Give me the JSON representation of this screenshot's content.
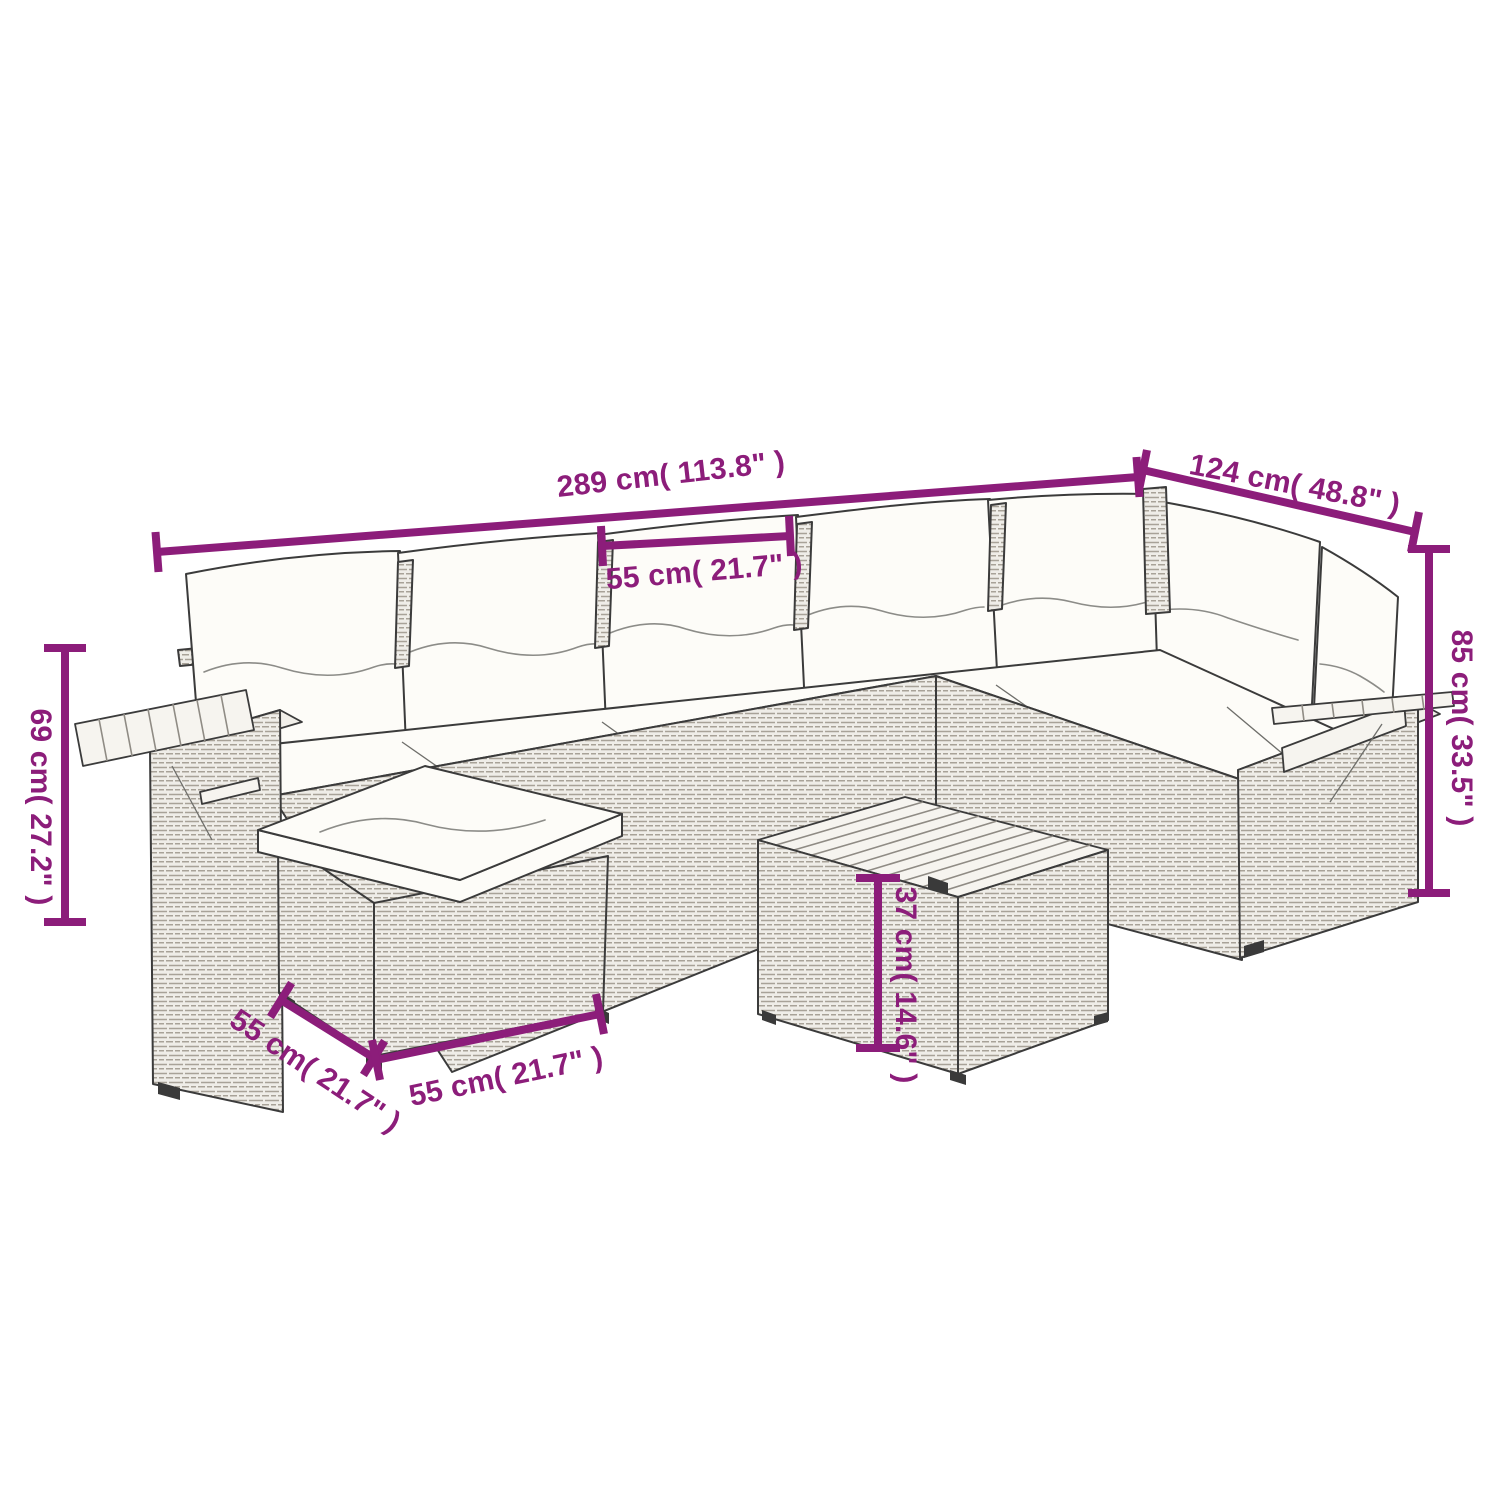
{
  "colors": {
    "accent": "#8c1d7a",
    "sketch": "#3b3b3b",
    "background": "#ffffff"
  },
  "illustration": {
    "subject": "L-shaped poly rattan garden lounge set line drawing",
    "parts": [
      "corner sofa with back and seat cushions",
      "left armrest with folding wood tray",
      "right armrest with folding wood tray",
      "ottoman with cushion",
      "square coffee table with wood slat top"
    ]
  },
  "dimensions": {
    "overall_width": {
      "label": "289 cm( 113.8\" )"
    },
    "overall_depth": {
      "label": "124 cm( 48.8\" )"
    },
    "seat_width": {
      "label": "55 cm( 21.7\" )"
    },
    "total_height": {
      "label": "85 cm( 33.5\" )"
    },
    "arm_height": {
      "label": "69 cm( 27.2\" )"
    },
    "ottoman_depth": {
      "label": "55 cm( 21.7\" )"
    },
    "ottoman_width": {
      "label": "55 cm( 21.7\" )"
    },
    "table_height": {
      "label": "37 cm( 14.6\" )"
    }
  }
}
